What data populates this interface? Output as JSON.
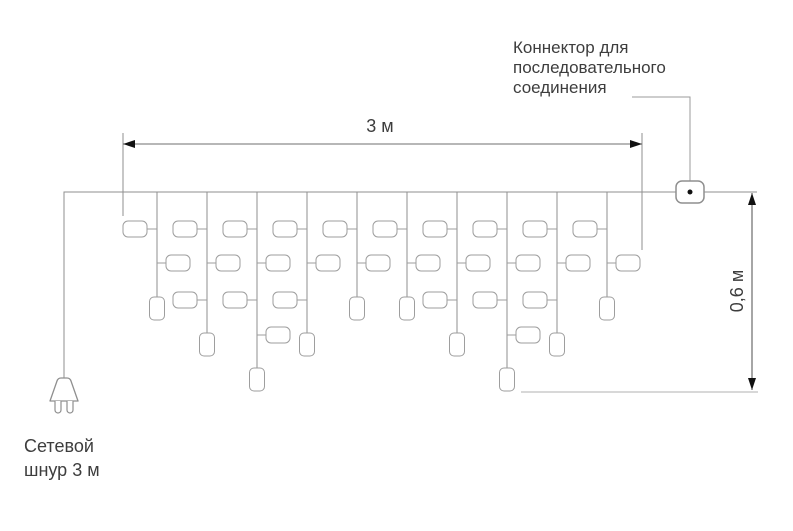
{
  "labels": {
    "connector_label": {
      "lines": [
        "Коннектор для",
        "последовательного",
        "соединения"
      ]
    },
    "power_cord_label": {
      "lines": [
        "Сетевой",
        "шнур 3 м"
      ]
    },
    "dim_length": "3 м",
    "dim_height": "0,6 м"
  },
  "colors": {
    "background": "#ffffff",
    "wire": "#8f8f8f",
    "bulb_stroke": "#9e9e9e",
    "dimension_line": "#6f6f6f",
    "height_dimension_line": "#4d4d4d",
    "extension_line": "#8f8f8f",
    "bottom_extension_line": "#b0b0b0",
    "leader_line": "#9b9b9b",
    "arrow": "#111111",
    "connector_dot": "#111111",
    "text": "#3d3d3d"
  },
  "diagram": {
    "wire": {
      "y": 192,
      "x_start": 64,
      "x_end": 757
    },
    "cord": {
      "x": 64,
      "y_top": 192,
      "y_bottom": 378
    },
    "plug": {
      "cx": 64,
      "body_top": 378,
      "body_bottom": 401,
      "top_half_w": 8,
      "bottom_half_w": 14,
      "prong_offset": 6,
      "prong_half_w": 3,
      "prong_len": 12
    },
    "connector": {
      "x": 676,
      "y": 181,
      "w": 28,
      "h": 22,
      "r": 6,
      "dot_r": 2.5,
      "leader": {
        "x1": 632,
        "y1": 97,
        "x2": 690,
        "y2": 181
      }
    },
    "rows": [
      {
        "y": 229,
        "side": "left"
      },
      {
        "y": 263,
        "side": "right"
      },
      {
        "y": 300,
        "side": "left"
      },
      {
        "y": 335,
        "side": "right"
      }
    ],
    "rows_per_size": {
      "short": 2,
      "medium": 3,
      "long": 4
    },
    "bulb": {
      "w": 24,
      "h": 16,
      "r": 5,
      "gap": 10
    },
    "terminal": {
      "w": 15,
      "h": 23,
      "r": 4.5,
      "top": {
        "short": 297,
        "medium": 333,
        "long": 368
      }
    },
    "strands": [
      {
        "x": 157,
        "size": "short"
      },
      {
        "x": 207,
        "size": "medium"
      },
      {
        "x": 257,
        "size": "long"
      },
      {
        "x": 307,
        "size": "medium"
      },
      {
        "x": 357,
        "size": "short"
      },
      {
        "x": 407,
        "size": "short"
      },
      {
        "x": 457,
        "size": "medium"
      },
      {
        "x": 507,
        "size": "long"
      },
      {
        "x": 557,
        "size": "medium"
      },
      {
        "x": 607,
        "size": "short"
      }
    ],
    "dim_length": {
      "y": 144,
      "x1": 123,
      "x2": 642,
      "ext": [
        {
          "x": 123,
          "y1": 133,
          "y2": 216
        },
        {
          "x": 642,
          "y1": 133,
          "y2": 250
        }
      ]
    },
    "dim_height": {
      "x": 752,
      "y1": 193,
      "y2": 390,
      "ext_bottom": {
        "y": 392,
        "x1": 521,
        "x2": 758
      }
    }
  }
}
